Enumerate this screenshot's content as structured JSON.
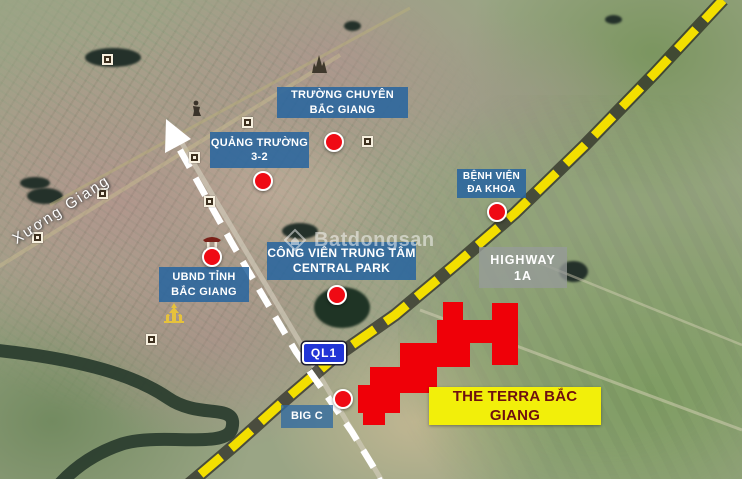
{
  "map": {
    "street_label": "Xương Giang",
    "watermark": "Batdongsan",
    "highway_sign": "QL1",
    "labels": {
      "truong_chuyen": {
        "line1": "TRƯỜNG CHUYÊN",
        "line2": "BẮC GIANG"
      },
      "quang_truong": {
        "line1": "QUẢNG TRƯỜNG",
        "line2": "3-2"
      },
      "benh_vien": {
        "line1": "BỆNH VIỆN",
        "line2": "ĐA KHOA"
      },
      "ubnd": {
        "line1": "UBND TỈNH",
        "line2": "BẮC GIANG"
      },
      "cong_vien": {
        "line1": "CÔNG VIÊN TRUNG TÂM",
        "line2": "CENTRAL PARK"
      },
      "highway": {
        "line1": "HIGHWAY",
        "line2": "1A"
      },
      "big_c": {
        "line1": "BIG C"
      },
      "terra": {
        "line1": "THE TERRA BẮC GIANG"
      }
    },
    "icons": {
      "route_arrow": "white-arrowhead",
      "poi_marker": "square-dot",
      "pagoda": "pagoda-silhouette",
      "shrine": "shrine-gate",
      "monument": "monument-spires",
      "statue": "statue-silhouette",
      "watermark_logo": "diamond-house"
    },
    "colors": {
      "label_blue": "#29659e",
      "label_gray": "#969b98",
      "label_yellow": "#f2ef0a",
      "terra_text": "#6e1010",
      "marker_red": "#ef0a14",
      "site_red": "#ef0008",
      "route_yellow": "#f3df00",
      "route_white": "#ffffff",
      "sign_blue": "#2135d6"
    }
  }
}
